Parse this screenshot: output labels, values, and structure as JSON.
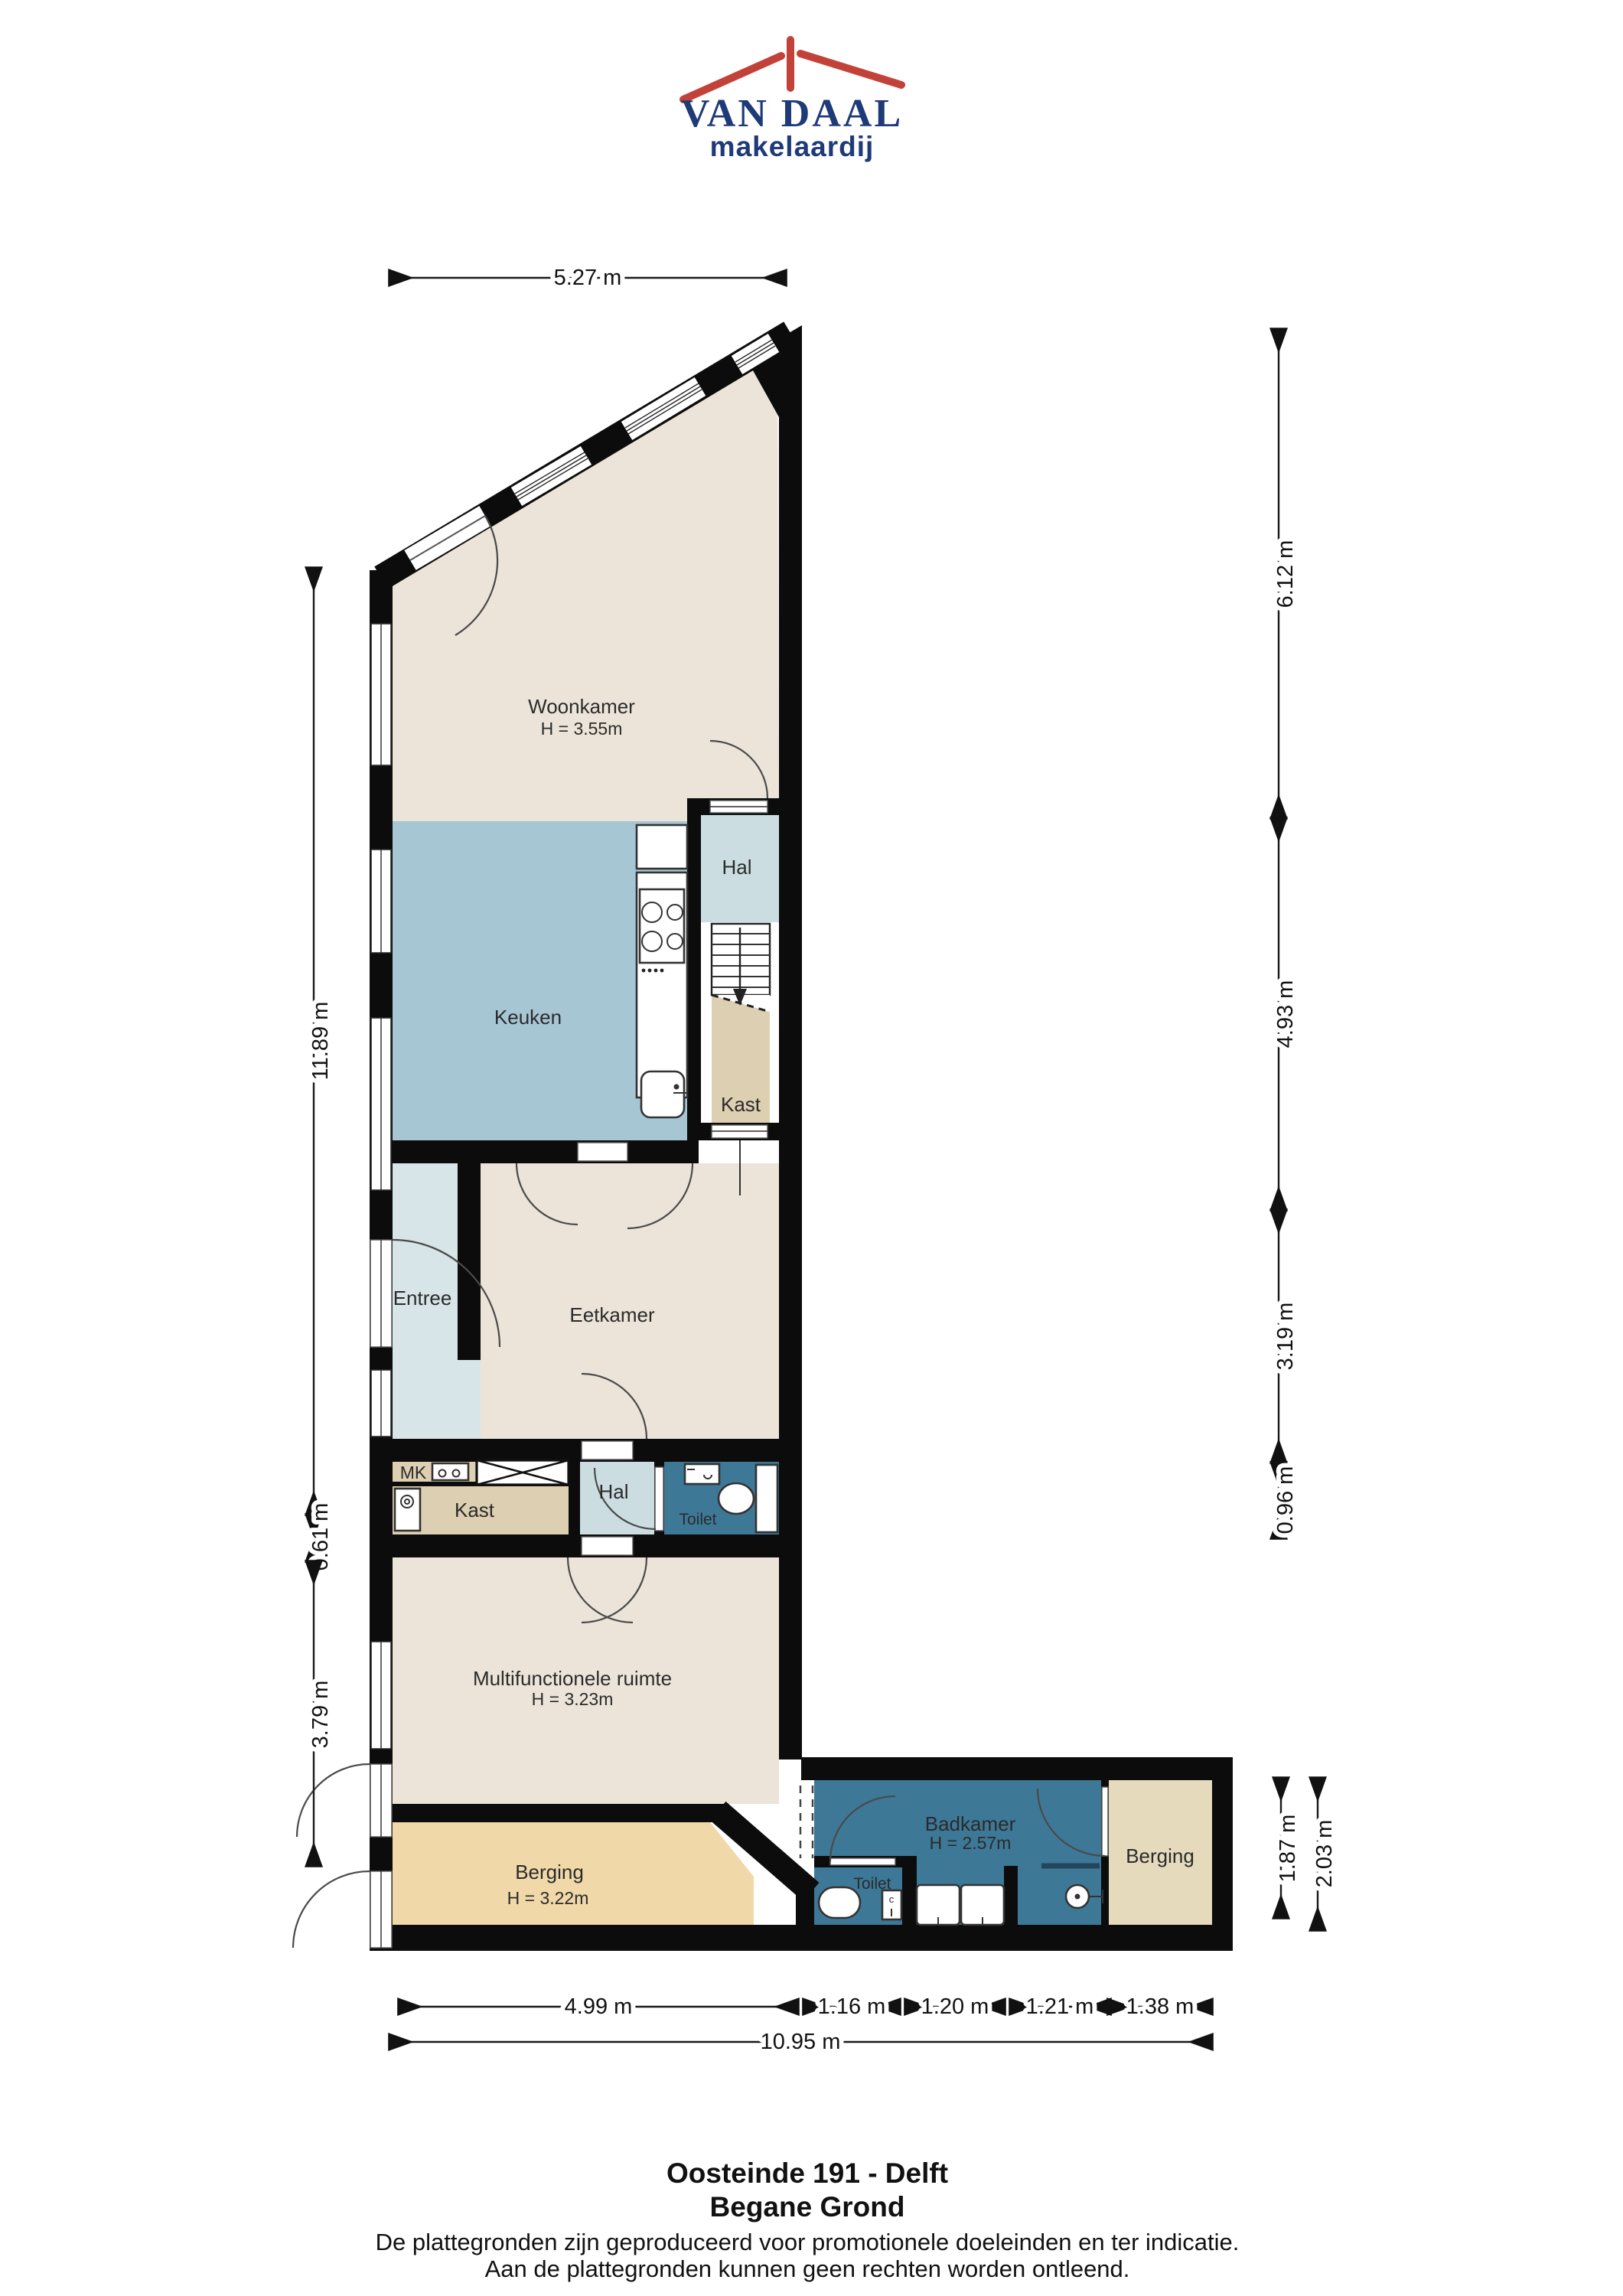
{
  "logo": {
    "name": "VAN DAAL",
    "tagline": "makelaardij",
    "brand_blue": "#1e3a78",
    "brand_red": "#c2423a"
  },
  "colors": {
    "wall": "#0c0c0c",
    "living": "#ece4d8",
    "kitchen": "#a7c6d4",
    "corridor": "#d7e4e8",
    "closet_tan": "#ddcfb1",
    "storage_orange": "#f0d8a8",
    "storage_beige": "#e5dabc",
    "wet_room": "#3d7897"
  },
  "rooms": {
    "woonkamer": {
      "label": "Woonkamer",
      "height": "H = 3.55m"
    },
    "keuken": {
      "label": "Keuken"
    },
    "hal_boven": {
      "label": "Hal"
    },
    "kast_boven": {
      "label": "Kast"
    },
    "entree": {
      "label": "Entree"
    },
    "eetkamer": {
      "label": "Eetkamer"
    },
    "mk": {
      "label": "MK"
    },
    "kast_strip": {
      "label": "Kast"
    },
    "hal_strip": {
      "label": "Hal"
    },
    "toilet_strip": {
      "label": "Toilet"
    },
    "multifunctionele": {
      "label": "Multifunctionele ruimte",
      "height": "H = 3.23m"
    },
    "berging_links": {
      "label": "Berging",
      "height": "H = 3.22m"
    },
    "badkamer": {
      "label": "Badkamer",
      "height": "H = 2.57m"
    },
    "toilet_wing": {
      "label": "Toilet"
    },
    "berging_rechts": {
      "label": "Berging"
    }
  },
  "dimensions": {
    "top": "5.27 m",
    "left": [
      "11.89 m",
      "0.61 m",
      "3.79 m"
    ],
    "right": [
      "6.12 m",
      "4.93 m",
      "3.19 m",
      "0.96 m"
    ],
    "wing_right": [
      "1.87 m",
      "2.03 m"
    ],
    "bottom": [
      "4.99 m",
      "1.16 m",
      "1.20 m",
      "1.21 m",
      "1.38 m"
    ],
    "bottom_total": "10.95 m"
  },
  "footer": {
    "title": "Oosteinde 191 - Delft",
    "subtitle": "Begane Grond",
    "disclaimer1": "De plattegronden zijn geproduceerd voor promotionele doeleinden en ter indicatie.",
    "disclaimer2": "Aan de plattegronden kunnen geen rechten worden ontleend."
  }
}
